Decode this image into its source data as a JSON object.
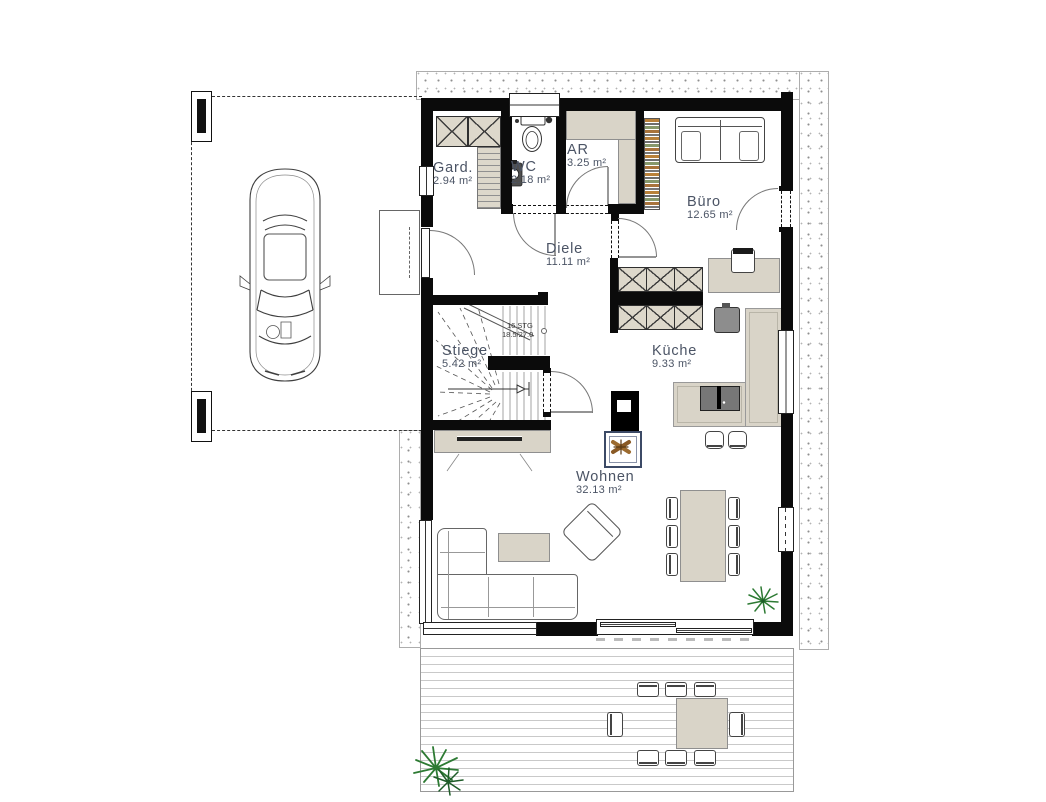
{
  "plan": {
    "rooms": [
      {
        "id": "gard",
        "name": "Gard.",
        "area": "2.94 m²"
      },
      {
        "id": "wc",
        "name": "WC",
        "area": "2.18 m²"
      },
      {
        "id": "ar",
        "name": "AR",
        "area": "3.25 m²"
      },
      {
        "id": "buero",
        "name": "Büro",
        "area": "12.65 m²"
      },
      {
        "id": "diele",
        "name": "Diele",
        "area": "11.11 m²"
      },
      {
        "id": "stiege",
        "name": "Stiege",
        "area": "5.42 m²"
      },
      {
        "id": "kueche",
        "name": "Küche",
        "area": "9.33 m²"
      },
      {
        "id": "wohnen",
        "name": "Wohnen",
        "area": "32.13 m²"
      }
    ],
    "stair_note": {
      "line1": "16 STG",
      "line2": "18.5/27.0"
    },
    "colors": {
      "wall": "#0b0b0b",
      "furniture": "#d9d4c8",
      "label": "#4b5465",
      "hearth_frame": "#3c4a66",
      "plant": "#2d7a33",
      "wood": "#9c6b2f"
    }
  }
}
